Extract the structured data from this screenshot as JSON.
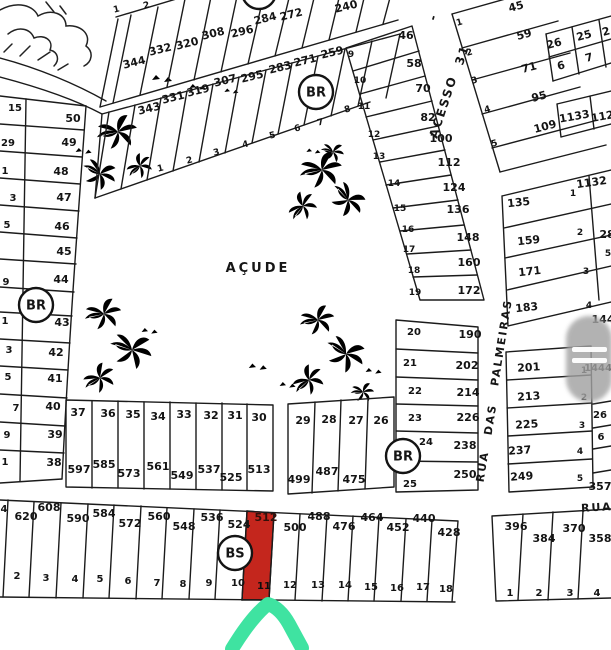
{
  "map": {
    "pond_label": "AÇUDE",
    "highlight": {
      "value": "512",
      "number": "11",
      "fill": "#c4261d",
      "arrow_color": "#3fe3a1"
    },
    "markers": [
      {
        "label": "BR",
        "x": 316,
        "y": 92
      },
      {
        "label": "BR",
        "x": 36,
        "y": 305
      },
      {
        "label": "BR",
        "x": 403,
        "y": 456
      },
      {
        "label": "BS",
        "x": 235,
        "y": 553
      },
      {
        "label": "",
        "x": 259,
        "y": -8
      }
    ],
    "street_labels": [
      {
        "text": "-",
        "x": 437,
        "y": 18,
        "r": -72,
        "fs": 12,
        "ls": 0
      },
      {
        "text": "ACESSO",
        "x": 447,
        "y": 108,
        "r": -72,
        "fs": 12,
        "ls": 2
      },
      {
        "text": "31",
        "x": 466,
        "y": 56,
        "r": -72,
        "fs": 12,
        "ls": 1
      },
      {
        "text": "PALMEIRAS",
        "x": 505,
        "y": 343,
        "r": -81,
        "fs": 11,
        "ls": 2
      },
      {
        "text": "DAS",
        "x": 494,
        "y": 420,
        "r": -81,
        "fs": 11,
        "ls": 2
      },
      {
        "text": "RUA",
        "x": 486,
        "y": 467,
        "r": -81,
        "fs": 11,
        "ls": 2
      },
      {
        "text": "RUA",
        "x": 597,
        "y": 511,
        "r": -3,
        "fs": 11,
        "ls": 1
      }
    ],
    "lot_labels": [
      {
        "t": "1",
        "x": 117,
        "y": 12,
        "fs": 9,
        "r": -14
      },
      {
        "t": "2",
        "x": 147,
        "y": 8,
        "fs": 9,
        "r": -14
      },
      {
        "t": "344",
        "x": 135,
        "y": 66,
        "r": -14
      },
      {
        "t": "332",
        "x": 161,
        "y": 53,
        "r": -14
      },
      {
        "t": "320",
        "x": 188,
        "y": 47,
        "r": -14
      },
      {
        "t": "308",
        "x": 214,
        "y": 37,
        "r": -14
      },
      {
        "t": "296",
        "x": 243,
        "y": 35,
        "r": -14
      },
      {
        "t": "284",
        "x": 266,
        "y": 22,
        "r": -14
      },
      {
        "t": "272",
        "x": 292,
        "y": 18,
        "r": -14
      },
      {
        "t": "240",
        "x": 347,
        "y": 10,
        "r": -14
      },
      {
        "t": "343",
        "x": 150,
        "y": 112,
        "r": -14
      },
      {
        "t": "331",
        "x": 174,
        "y": 101,
        "r": -14
      },
      {
        "t": "319",
        "x": 199,
        "y": 94,
        "r": -14
      },
      {
        "t": "307",
        "x": 226,
        "y": 84,
        "r": -14
      },
      {
        "t": "295",
        "x": 253,
        "y": 80,
        "r": -14
      },
      {
        "t": "283",
        "x": 281,
        "y": 71,
        "r": -14
      },
      {
        "t": "271",
        "x": 306,
        "y": 64,
        "r": -14
      },
      {
        "t": "259",
        "x": 333,
        "y": 56,
        "r": -14
      },
      {
        "t": "1",
        "x": 161,
        "y": 171,
        "fs": 9,
        "r": -14
      },
      {
        "t": "2",
        "x": 190,
        "y": 163,
        "fs": 9,
        "r": -14
      },
      {
        "t": "3",
        "x": 217,
        "y": 155,
        "fs": 9,
        "r": -14
      },
      {
        "t": "4",
        "x": 246,
        "y": 147,
        "fs": 9,
        "r": -14
      },
      {
        "t": "5",
        "x": 273,
        "y": 138,
        "fs": 9,
        "r": -14
      },
      {
        "t": "6",
        "x": 298,
        "y": 131,
        "fs": 9,
        "r": -14
      },
      {
        "t": "7",
        "x": 321,
        "y": 125,
        "fs": 9,
        "r": -14
      },
      {
        "t": "8",
        "x": 348,
        "y": 112,
        "fs": 9,
        "r": -14
      },
      {
        "t": "9",
        "x": 351,
        "y": 57,
        "fs": 9
      },
      {
        "t": "10",
        "x": 360,
        "y": 83,
        "fs": 9
      },
      {
        "t": "11",
        "x": 364,
        "y": 109,
        "fs": 9
      },
      {
        "t": "12",
        "x": 374,
        "y": 137,
        "fs": 9
      },
      {
        "t": "13",
        "x": 379,
        "y": 159,
        "fs": 9
      },
      {
        "t": "14",
        "x": 394,
        "y": 186,
        "fs": 9
      },
      {
        "t": "15",
        "x": 400,
        "y": 211,
        "fs": 9
      },
      {
        "t": "16",
        "x": 408,
        "y": 232,
        "fs": 9
      },
      {
        "t": "17",
        "x": 409,
        "y": 252,
        "fs": 9
      },
      {
        "t": "18",
        "x": 414,
        "y": 273,
        "fs": 9
      },
      {
        "t": "19",
        "x": 415,
        "y": 295,
        "fs": 9
      },
      {
        "t": "46",
        "x": 406,
        "y": 39
      },
      {
        "t": "58",
        "x": 414,
        "y": 67
      },
      {
        "t": "70",
        "x": 423,
        "y": 92
      },
      {
        "t": "82",
        "x": 428,
        "y": 121
      },
      {
        "t": "100",
        "x": 441,
        "y": 142
      },
      {
        "t": "112",
        "x": 449,
        "y": 166
      },
      {
        "t": "124",
        "x": 454,
        "y": 191
      },
      {
        "t": "136",
        "x": 458,
        "y": 213
      },
      {
        "t": "148",
        "x": 468,
        "y": 241
      },
      {
        "t": "160",
        "x": 469,
        "y": 266
      },
      {
        "t": "172",
        "x": 469,
        "y": 294
      },
      {
        "t": "1",
        "x": 460,
        "y": 25,
        "fs": 9,
        "r": -15
      },
      {
        "t": "2",
        "x": 470,
        "y": 55,
        "fs": 9,
        "r": -15
      },
      {
        "t": "3",
        "x": 475,
        "y": 83,
        "fs": 9,
        "r": -15
      },
      {
        "t": "4",
        "x": 488,
        "y": 112,
        "fs": 9,
        "r": -15
      },
      {
        "t": "5",
        "x": 495,
        "y": 146,
        "fs": 9,
        "r": -15
      },
      {
        "t": "45",
        "x": 517,
        "y": 10,
        "r": -15
      },
      {
        "t": "59",
        "x": 525,
        "y": 38,
        "r": -15
      },
      {
        "t": "71",
        "x": 530,
        "y": 71,
        "r": -15
      },
      {
        "t": "95",
        "x": 540,
        "y": 100,
        "r": -15
      },
      {
        "t": "109",
        "x": 546,
        "y": 130,
        "r": -15
      },
      {
        "t": "26",
        "x": 555,
        "y": 47,
        "r": -15
      },
      {
        "t": "25",
        "x": 585,
        "y": 39,
        "r": -15
      },
      {
        "t": "2",
        "x": 607,
        "y": 35,
        "r": -15
      },
      {
        "t": "6",
        "x": 562,
        "y": 69,
        "r": -15
      },
      {
        "t": "7",
        "x": 590,
        "y": 61,
        "r": -15
      },
      {
        "t": "1133",
        "x": 575,
        "y": 120,
        "r": -10
      },
      {
        "t": "112",
        "x": 603,
        "y": 120,
        "r": -10
      },
      {
        "t": "1132",
        "x": 592,
        "y": 186,
        "r": -8
      },
      {
        "t": "1",
        "x": 573,
        "y": 196,
        "fs": 9
      },
      {
        "t": "135",
        "x": 519,
        "y": 206,
        "r": -6
      },
      {
        "t": "159",
        "x": 529,
        "y": 244,
        "r": -6
      },
      {
        "t": "2",
        "x": 580,
        "y": 235,
        "fs": 9
      },
      {
        "t": "28",
        "x": 607,
        "y": 238
      },
      {
        "t": "171",
        "x": 530,
        "y": 275,
        "r": -6
      },
      {
        "t": "3",
        "x": 586,
        "y": 274,
        "fs": 9
      },
      {
        "t": "5",
        "x": 608,
        "y": 256,
        "fs": 9
      },
      {
        "t": "183",
        "x": 527,
        "y": 311,
        "r": -6
      },
      {
        "t": "4",
        "x": 589,
        "y": 308,
        "fs": 9
      },
      {
        "t": "144",
        "x": 603,
        "y": 323
      },
      {
        "t": "201",
        "x": 529,
        "y": 371,
        "r": -4
      },
      {
        "t": "1",
        "x": 584,
        "y": 373,
        "fs": 9
      },
      {
        "t": "1444",
        "x": 598,
        "y": 371,
        "fs": 10
      },
      {
        "t": "213",
        "x": 529,
        "y": 400,
        "r": -4
      },
      {
        "t": "2",
        "x": 584,
        "y": 400,
        "fs": 9
      },
      {
        "t": "225",
        "x": 527,
        "y": 428,
        "r": -4
      },
      {
        "t": "3",
        "x": 582,
        "y": 428,
        "fs": 9
      },
      {
        "t": "26",
        "x": 600,
        "y": 418,
        "fs": 10
      },
      {
        "t": "237",
        "x": 520,
        "y": 454,
        "r": -4
      },
      {
        "t": "4",
        "x": 580,
        "y": 454,
        "fs": 9
      },
      {
        "t": "6",
        "x": 601,
        "y": 440,
        "fs": 10
      },
      {
        "t": "249",
        "x": 522,
        "y": 480,
        "r": -4
      },
      {
        "t": "5",
        "x": 580,
        "y": 481,
        "fs": 9
      },
      {
        "t": "357",
        "x": 600,
        "y": 490
      },
      {
        "t": "20",
        "x": 414,
        "y": 335,
        "fs": 10
      },
      {
        "t": "190",
        "x": 470,
        "y": 338
      },
      {
        "t": "21",
        "x": 410,
        "y": 366,
        "fs": 10
      },
      {
        "t": "202",
        "x": 467,
        "y": 369
      },
      {
        "t": "22",
        "x": 415,
        "y": 394,
        "fs": 10
      },
      {
        "t": "214",
        "x": 468,
        "y": 396
      },
      {
        "t": "23",
        "x": 415,
        "y": 421,
        "fs": 10
      },
      {
        "t": "226",
        "x": 468,
        "y": 421
      },
      {
        "t": "24",
        "x": 426,
        "y": 445,
        "fs": 10
      },
      {
        "t": "238",
        "x": 465,
        "y": 449
      },
      {
        "t": "25",
        "x": 410,
        "y": 487,
        "fs": 10
      },
      {
        "t": "250",
        "x": 465,
        "y": 478
      },
      {
        "t": "37",
        "x": 78,
        "y": 416
      },
      {
        "t": "36",
        "x": 108,
        "y": 417
      },
      {
        "t": "35",
        "x": 133,
        "y": 418
      },
      {
        "t": "34",
        "x": 158,
        "y": 420
      },
      {
        "t": "33",
        "x": 184,
        "y": 418
      },
      {
        "t": "32",
        "x": 211,
        "y": 419
      },
      {
        "t": "31",
        "x": 235,
        "y": 419
      },
      {
        "t": "30",
        "x": 259,
        "y": 421
      },
      {
        "t": "597",
        "x": 79,
        "y": 473
      },
      {
        "t": "585",
        "x": 104,
        "y": 468
      },
      {
        "t": "573",
        "x": 129,
        "y": 477
      },
      {
        "t": "561",
        "x": 158,
        "y": 470
      },
      {
        "t": "549",
        "x": 182,
        "y": 479
      },
      {
        "t": "537",
        "x": 209,
        "y": 473
      },
      {
        "t": "525",
        "x": 231,
        "y": 481
      },
      {
        "t": "513",
        "x": 259,
        "y": 473
      },
      {
        "t": "29",
        "x": 303,
        "y": 424
      },
      {
        "t": "28",
        "x": 329,
        "y": 423
      },
      {
        "t": "27",
        "x": 356,
        "y": 424
      },
      {
        "t": "26",
        "x": 381,
        "y": 424
      },
      {
        "t": "499",
        "x": 299,
        "y": 483
      },
      {
        "t": "487",
        "x": 327,
        "y": 475
      },
      {
        "t": "475",
        "x": 354,
        "y": 483
      },
      {
        "t": "15",
        "x": 15,
        "y": 111,
        "fs": 10
      },
      {
        "t": "50",
        "x": 73,
        "y": 122
      },
      {
        "t": "29",
        "x": 8,
        "y": 146,
        "fs": 10
      },
      {
        "t": "49",
        "x": 69,
        "y": 146
      },
      {
        "t": "1",
        "x": 5,
        "y": 174,
        "fs": 10
      },
      {
        "t": "48",
        "x": 61,
        "y": 175
      },
      {
        "t": "3",
        "x": 13,
        "y": 201,
        "fs": 10
      },
      {
        "t": "47",
        "x": 64,
        "y": 201
      },
      {
        "t": "5",
        "x": 7,
        "y": 228,
        "fs": 10
      },
      {
        "t": "46",
        "x": 62,
        "y": 230
      },
      {
        "t": "45",
        "x": 64,
        "y": 255
      },
      {
        "t": "9",
        "x": 6,
        "y": 285,
        "fs": 10
      },
      {
        "t": "44",
        "x": 61,
        "y": 283
      },
      {
        "t": "1",
        "x": 5,
        "y": 324,
        "fs": 10
      },
      {
        "t": "43",
        "x": 62,
        "y": 326
      },
      {
        "t": "3",
        "x": 9,
        "y": 353,
        "fs": 10
      },
      {
        "t": "42",
        "x": 56,
        "y": 356
      },
      {
        "t": "5",
        "x": 8,
        "y": 380,
        "fs": 10
      },
      {
        "t": "41",
        "x": 55,
        "y": 382
      },
      {
        "t": "7",
        "x": 16,
        "y": 411,
        "fs": 10
      },
      {
        "t": "40",
        "x": 53,
        "y": 410
      },
      {
        "t": "9",
        "x": 7,
        "y": 438,
        "fs": 10
      },
      {
        "t": "39",
        "x": 55,
        "y": 438
      },
      {
        "t": "1",
        "x": 5,
        "y": 465,
        "fs": 10
      },
      {
        "t": "38",
        "x": 54,
        "y": 466
      },
      {
        "t": "4",
        "x": 4,
        "y": 512,
        "fs": 10
      },
      {
        "t": "620",
        "x": 26,
        "y": 520
      },
      {
        "t": "608",
        "x": 49,
        "y": 511
      },
      {
        "t": "590",
        "x": 78,
        "y": 522
      },
      {
        "t": "584",
        "x": 104,
        "y": 517
      },
      {
        "t": "572",
        "x": 130,
        "y": 527
      },
      {
        "t": "560",
        "x": 159,
        "y": 520
      },
      {
        "t": "548",
        "x": 184,
        "y": 530
      },
      {
        "t": "536",
        "x": 212,
        "y": 521
      },
      {
        "t": "524",
        "x": 239,
        "y": 528
      },
      {
        "t": "500",
        "x": 295,
        "y": 531
      },
      {
        "t": "488",
        "x": 319,
        "y": 520
      },
      {
        "t": "476",
        "x": 344,
        "y": 530
      },
      {
        "t": "464",
        "x": 372,
        "y": 521
      },
      {
        "t": "452",
        "x": 398,
        "y": 531
      },
      {
        "t": "440",
        "x": 424,
        "y": 522
      },
      {
        "t": "428",
        "x": 449,
        "y": 536
      },
      {
        "t": "2",
        "x": 17,
        "y": 579,
        "fs": 10
      },
      {
        "t": "3",
        "x": 46,
        "y": 581,
        "fs": 10
      },
      {
        "t": "4",
        "x": 75,
        "y": 582,
        "fs": 10
      },
      {
        "t": "5",
        "x": 100,
        "y": 582,
        "fs": 10
      },
      {
        "t": "6",
        "x": 128,
        "y": 584,
        "fs": 10
      },
      {
        "t": "7",
        "x": 157,
        "y": 586,
        "fs": 10
      },
      {
        "t": "8",
        "x": 183,
        "y": 587,
        "fs": 10
      },
      {
        "t": "9",
        "x": 209,
        "y": 586,
        "fs": 10
      },
      {
        "t": "10",
        "x": 238,
        "y": 586,
        "fs": 10
      },
      {
        "t": "12",
        "x": 290,
        "y": 588,
        "fs": 10
      },
      {
        "t": "13",
        "x": 318,
        "y": 588,
        "fs": 10
      },
      {
        "t": "14",
        "x": 345,
        "y": 588,
        "fs": 10
      },
      {
        "t": "15",
        "x": 371,
        "y": 590,
        "fs": 10
      },
      {
        "t": "16",
        "x": 397,
        "y": 591,
        "fs": 10
      },
      {
        "t": "17",
        "x": 423,
        "y": 590,
        "fs": 10
      },
      {
        "t": "18",
        "x": 446,
        "y": 592,
        "fs": 10
      },
      {
        "t": "396",
        "x": 516,
        "y": 530
      },
      {
        "t": "384",
        "x": 544,
        "y": 542
      },
      {
        "t": "370",
        "x": 574,
        "y": 532
      },
      {
        "t": "358",
        "x": 600,
        "y": 542
      },
      {
        "t": "1",
        "x": 510,
        "y": 596,
        "fs": 10
      },
      {
        "t": "2",
        "x": 539,
        "y": 596,
        "fs": 10
      },
      {
        "t": "3",
        "x": 570,
        "y": 596,
        "fs": 10
      },
      {
        "t": "4",
        "x": 597,
        "y": 596,
        "fs": 10
      }
    ]
  }
}
